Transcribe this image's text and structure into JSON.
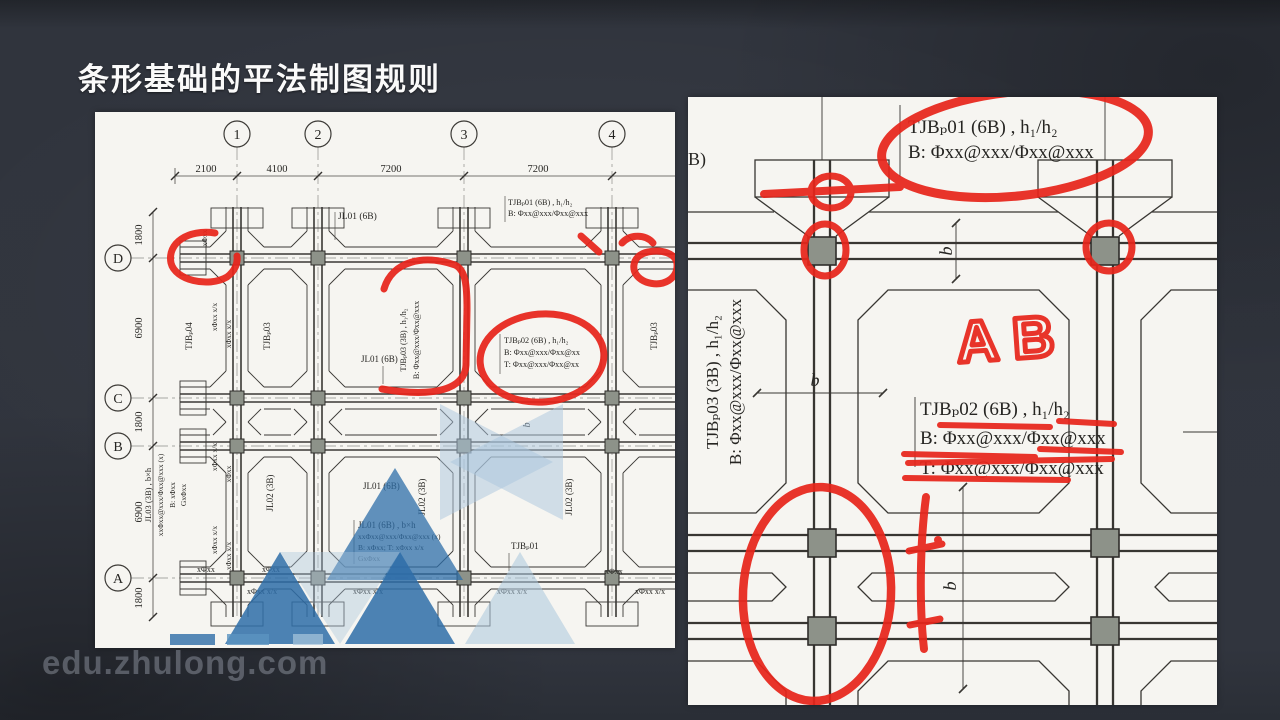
{
  "page": {
    "title": "条形基础的平法制图规则",
    "watermark": "edu.zhulong.com"
  },
  "colors": {
    "background": "#31353e",
    "paper": "#f6f5f1",
    "ink": "#3a3835",
    "annotation_red": "#e7251b",
    "column_gray": "#8d9289",
    "logo_blue_dark": "#2e6da8",
    "logo_blue_light": "#a9c6dd"
  },
  "left": {
    "axes_top": [
      "1",
      "2",
      "3",
      "4"
    ],
    "dims_top": [
      "2100",
      "4100",
      "7200",
      "7200"
    ],
    "axes_left": [
      "D",
      "C",
      "B",
      "A"
    ],
    "dims_left": [
      "1800",
      "6900",
      "1800",
      "6900",
      "1800"
    ],
    "labels": {
      "jl01": "JL01 (6B)",
      "jl02": "JL02 (3B)",
      "jl01_bh": "JL01 (6B) , b×h",
      "jl01_l2": "xxΦxx@xxx/Φxx@xxx (x)",
      "jl01_l3": "B: xΦxx; T: xΦxx  x/x",
      "jl01_l4": "GxΦxx",
      "jl03_bh": "JL03 (3B) , b×h",
      "jl03_l2": "xxΦxx@xxx/Φxx@xxx (x)",
      "jl03_l3": "B: xΦxx",
      "jl03_l4": "GxΦxx",
      "tjbp01": "TJBₚ01 (6B) , h₁/h₂",
      "tjbp01_b": "B: Φxx@xxx/Φxx@xxx",
      "tjbp01_s": "TJBₚ01",
      "tjbp02": "TJBₚ02 (6B) , h₁/h₂",
      "tjbp02_b": "B: Φxx@xxx/Φxx@xx",
      "tjbp02_t": "T: Φxx@xxx/Φxx@xx",
      "tjbp03": "TJBₚ03",
      "tjbp03_f1": "TJBₚ03 (3B) , h₁/h₂",
      "tjbp03_f2": "B: Φxx@xxx/Φxx@xxx",
      "tjbp04": "TJBₚ04",
      "rebar": "xΦxx  x/x",
      "rebar_s": "xΦxx",
      "b": "b"
    }
  },
  "right": {
    "edge": "B)",
    "tjbp01_1": "TJBₚ01 (6B) , h₁/h₂",
    "tjbp01_2": "B: Φxx@xxx/Φxx@xxx",
    "tjbp02_1": "TJBₚ02 (6B) , h₁/h₂",
    "tjbp02_2": "B: Φxx@xxx/Φxx@xxx",
    "tjbp02_3": "T: Φxx@xxx/Φxx@xxx",
    "tjbp03_1": "TJBₚ03 (3B) , h₁/h₂",
    "tjbp03_2": "B: Φxx@xxx/Φxx@xxx",
    "ab": "AB",
    "b": "b"
  }
}
